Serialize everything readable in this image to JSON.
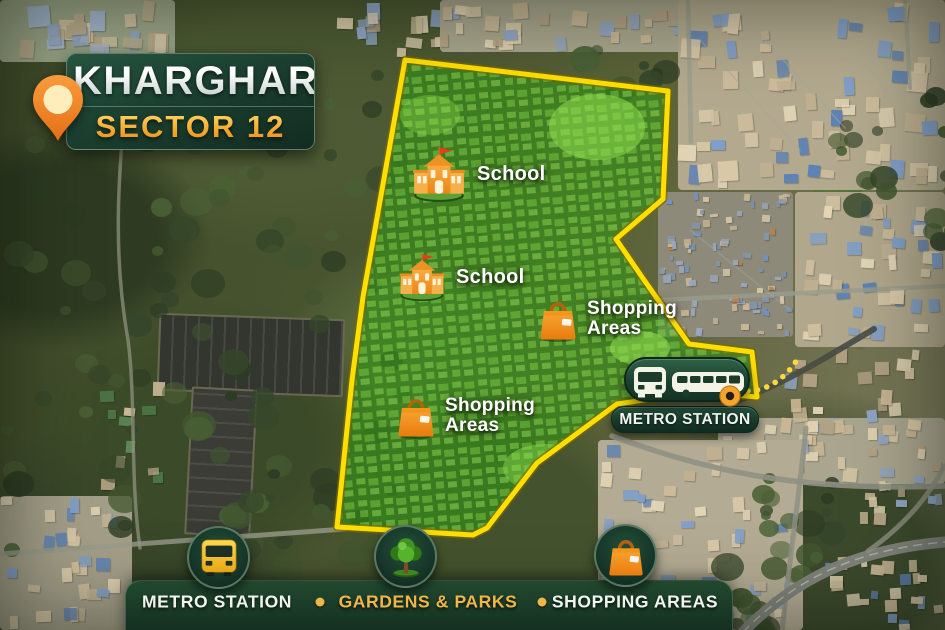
{
  "title": {
    "city": "KHARGHAR",
    "sector": "SECTOR 12",
    "pin_icon": "location-pin-icon"
  },
  "map": {
    "boundary_points": "405,60 668,91 663,199 616,239 642,277 689,344 752,352 757,397 700,392 617,404 537,463 487,528 473,535 337,527 352,380 363,297",
    "boundary_color": "#FFDF00",
    "area_fill_color": "#3FA51E",
    "markers": [
      {
        "id": "school-1",
        "type": "school",
        "label": "School",
        "x": 410,
        "y": 145
      },
      {
        "id": "school-2",
        "type": "school",
        "label": "School",
        "x": 397,
        "y": 252
      },
      {
        "id": "shopping-1",
        "type": "shopping",
        "label": "Shopping Areas",
        "x": 538,
        "y": 296
      },
      {
        "id": "shopping-2",
        "type": "shopping",
        "label": "Shopping Areas",
        "x": 396,
        "y": 393
      },
      {
        "id": "metro",
        "type": "metro",
        "label": "METRO STATION",
        "x": 611,
        "y": 357
      }
    ]
  },
  "legend": {
    "items": [
      {
        "icon": "bus-icon",
        "label": "METRO STATION",
        "color": "#F1F4EE"
      },
      {
        "icon": "tree-icon",
        "label": "GARDENS & PARKS",
        "color": "#F0B64A"
      },
      {
        "icon": "bag-icon",
        "label": "SHOPPING AREAS",
        "color": "#F1F4EE"
      }
    ]
  },
  "colors": {
    "accent_gold": "#F0B64A",
    "panel_green": "#1B4130",
    "icon_orange": "#F59B23"
  }
}
